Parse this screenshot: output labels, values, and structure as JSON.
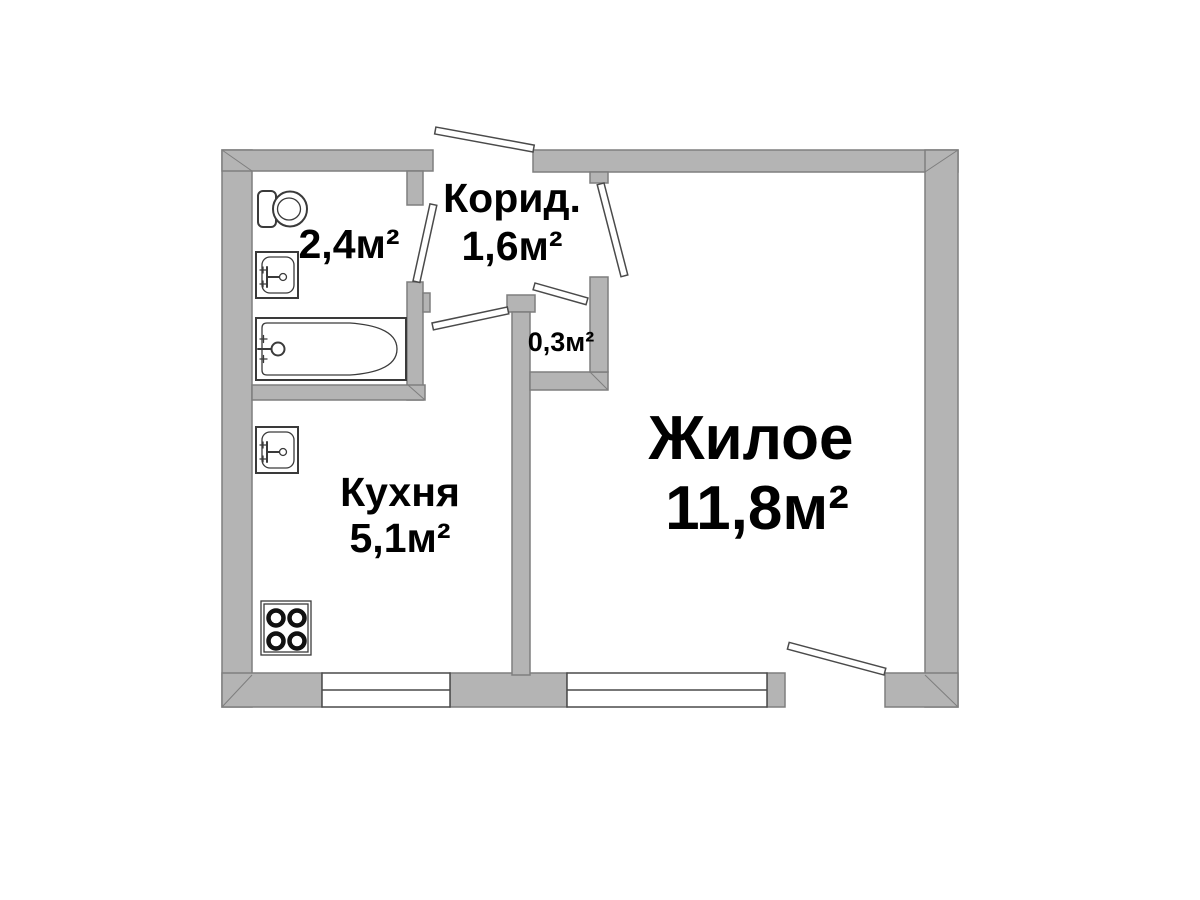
{
  "rooms": {
    "bathroom": {
      "area": "2,4м²"
    },
    "corridor": {
      "name": "Корид.",
      "area": "1,6м²"
    },
    "closet": {
      "area": "0,3м²"
    },
    "kitchen": {
      "name": "Кухня",
      "area": "5,1м²"
    },
    "living": {
      "name": "Жилое",
      "area": "11,8м²"
    }
  },
  "fixtures": {
    "bathroom": [
      "toilet-icon",
      "sink-icon",
      "bathtub-icon"
    ],
    "kitchen": [
      "sink-icon",
      "stove-icon"
    ]
  },
  "openings": {
    "doors": [
      "entrance",
      "bathroom",
      "kitchen",
      "closet",
      "living-room",
      "balcony"
    ],
    "windows": [
      "kitchen-window",
      "living-room-window"
    ]
  },
  "colors": {
    "wall_fill": "#b4b4b4",
    "wall_stroke": "#7e7e7e",
    "line_color": "#4a4a4a",
    "text_color": "#000000"
  }
}
